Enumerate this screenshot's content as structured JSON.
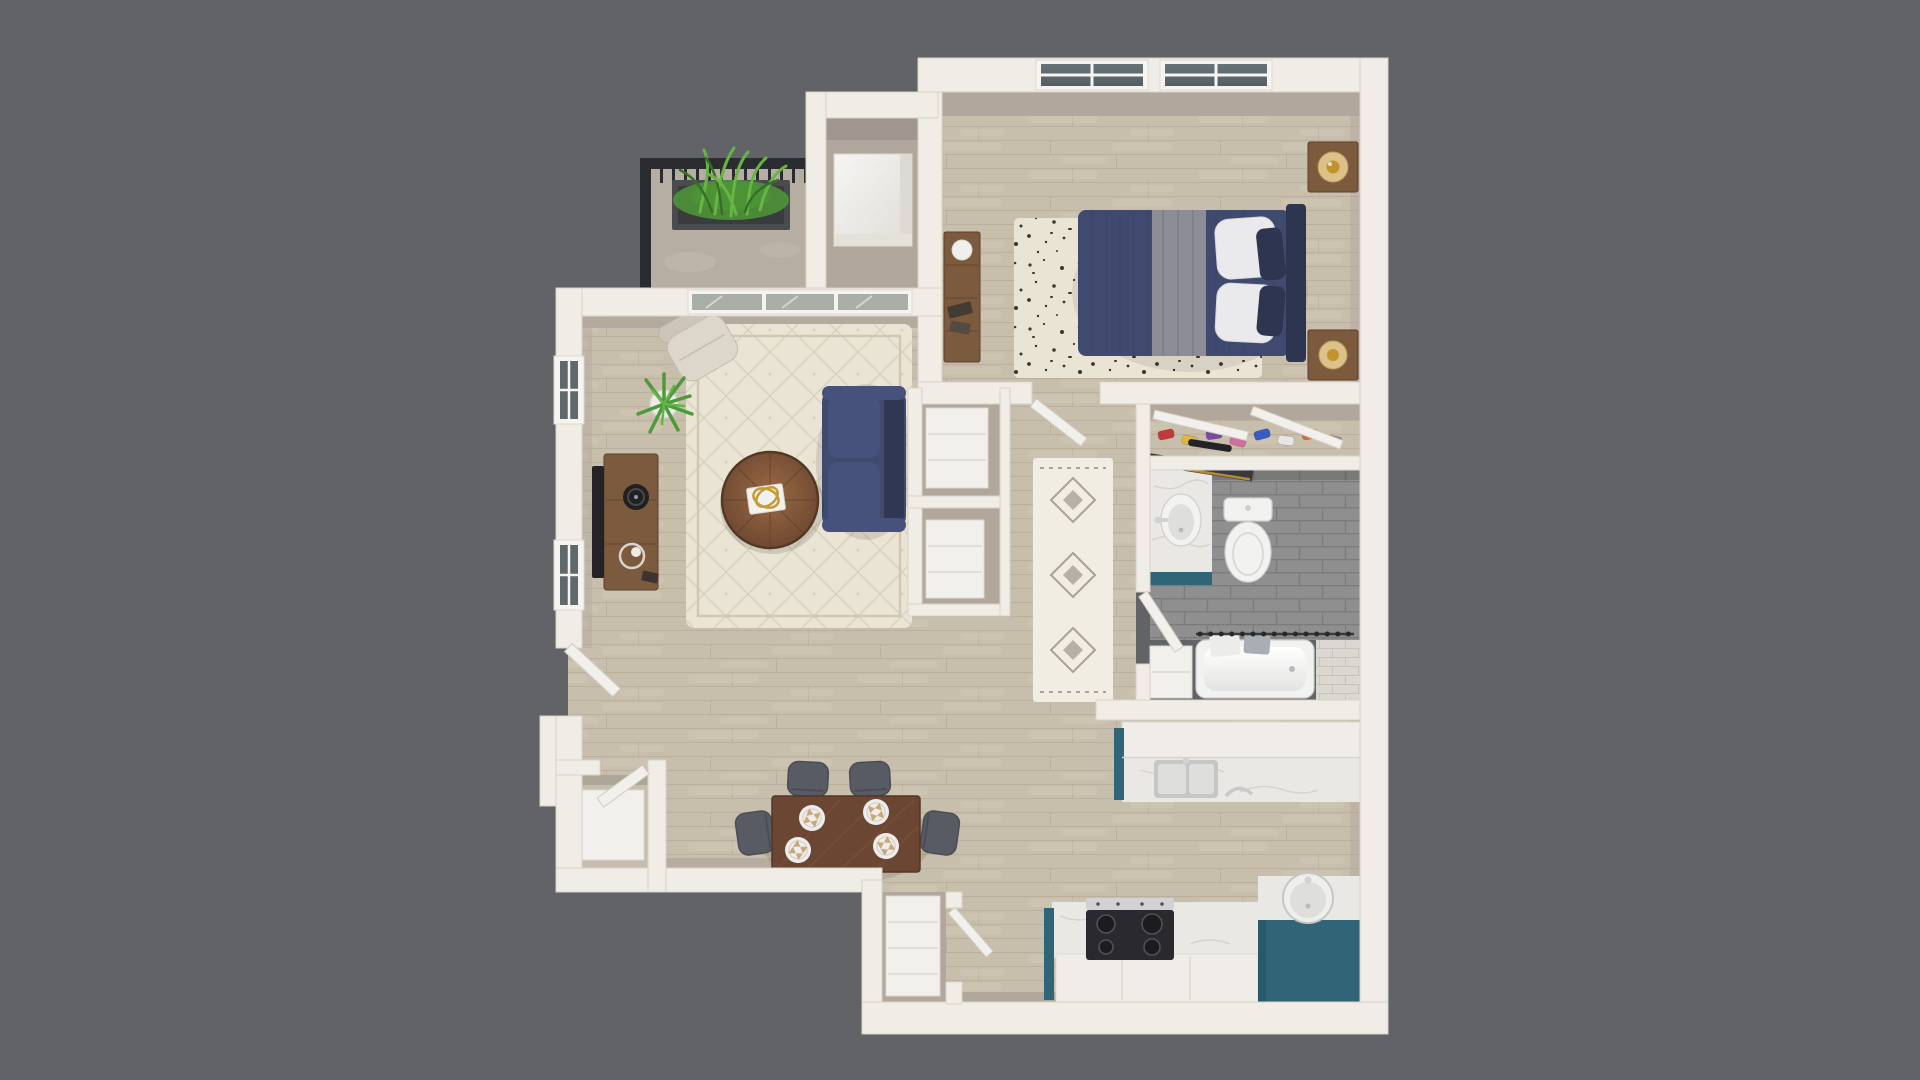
{
  "scene": {
    "type": "3d-floorplan-render",
    "description": "Top-down 3D dollhouse rendering of a one-bedroom, one-bathroom apartment floor plan centered on a plain dark gray background. No text, labels or UI controls are visible in the image.",
    "background": "#616367"
  },
  "palette": {
    "background": "#616367",
    "wall": "#f0ede7",
    "wallEdge": "#d8d2c8",
    "wallFace": "#b2a79d",
    "floorWood": "#c8beac",
    "floorLine": "#b4a995",
    "floorStreak": "#d6ccbb",
    "concrete": "#b6aea1",
    "railing": "#2b2c2f",
    "planter": "#494b4e",
    "soil": "#3a3b3d",
    "grass": "#4c9338",
    "grassLight": "#68b545",
    "grassDark": "#386f28",
    "rugCream": "#eae4d4",
    "rugBorder": "#d0c8b5",
    "rugSpeckle": "#3d362e",
    "runnerBase": "#f1ede2",
    "runnerGray": "#a8a195",
    "navy": "#3f4a6e",
    "navyDark": "#2e3550",
    "navyCushion": "#46527c",
    "grayThrow": "#8d8d97",
    "pillowWhite": "#eaeaec",
    "woodBrown": "#7b5a3e",
    "woodDark": "#5d3e2b",
    "tableWood": "#6b4733",
    "tableGrain": "#7d523a",
    "chairGray": "#585b63",
    "chairDark": "#4a4d55",
    "tvBlack": "#232327",
    "glassDark": "#5f686b",
    "glassPale": "#a9aea8",
    "doorWhite": "#f2f0ec",
    "teal": "#2f6577",
    "marble": "#eae8e4",
    "counterWhite": "#f0ede8",
    "vein": "#d7d3cc",
    "steel": "#d2d2d4",
    "stove": "#2a2a2e",
    "burner": "#1c1c1f",
    "burnerRing": "#505056",
    "tileGray": "#8f8f8f",
    "tileGrout": "#7c7c7c",
    "tileWhite": "#dbd8d2",
    "tileWhiteLine": "#c8c4bc",
    "porcelain": "#f2f2f1",
    "porcelainShade": "#dededd",
    "fixtureLine": "#cfcfcd",
    "lampGold": "#c1932f",
    "lampShade": "#dcc288",
    "gold": "#c59a33",
    "mirrorDark": "#39393b"
  },
  "rooms": [
    {
      "id": "balcony",
      "name": "Balcony",
      "items": [
        "black metal railing",
        "concrete floor",
        "dark planter box with tall green grass plant"
      ]
    },
    {
      "id": "utility-closet",
      "name": "Utility Closet",
      "items": [
        "white water heater"
      ]
    },
    {
      "id": "bedroom",
      "name": "Bedroom",
      "items": [
        "bed with navy duvet, gray throw blanket, white and navy pillows",
        "dark navy headboard",
        "two wood nightstands",
        "two brass lamps",
        "long wood dresser with decor",
        "cream speckled area rug",
        "two divided-lite windows with dark glass"
      ]
    },
    {
      "id": "bedroom-closet",
      "name": "Bedroom Closet",
      "items": [
        "angled sliding door panels",
        "row of colorful shoes"
      ]
    },
    {
      "id": "bathroom",
      "name": "Bathroom",
      "items": [
        "vanity with marble top, sink and teal cabinet",
        "leaning dark-framed mirror with gold trim",
        "black sconce bar",
        "toilet",
        "bathtub",
        "shower curtain rod with rings",
        "gray tile floor",
        "white tile tub surround",
        "linen nook"
      ]
    },
    {
      "id": "hallway",
      "name": "Hallway",
      "items": [
        "white runner rug with gray diamond motifs",
        "open bedroom door",
        "open bathroom door"
      ]
    },
    {
      "id": "linen-closets",
      "name": "Linen Closets",
      "items": [
        "white shelving unit",
        "white shelving unit"
      ]
    },
    {
      "id": "living-room",
      "name": "Living Room",
      "items": [
        "navy sofa",
        "round wood coffee table",
        "gold rings decor on white book",
        "dark wood TV console",
        "flat-screen TV",
        "record player",
        "round tray with candle",
        "cream accent chair",
        "potted snake plant",
        "cream patterned area rug",
        "sliding glass balcony door",
        "two windows with dark glass"
      ]
    },
    {
      "id": "dining-area",
      "name": "Dining Area",
      "items": [
        "rectangular dark wood dining table",
        "four gray upholstered chairs",
        "four white plates with tan napkins"
      ]
    },
    {
      "id": "kitchen",
      "name": "Kitchen",
      "items": [
        "breakfast-bar peninsula with double sink and faucet",
        "teal base cabinets",
        "white marble counters",
        "black four-burner cooktop with stainless trim",
        "corner counter with round sink"
      ]
    },
    {
      "id": "pantry",
      "name": "Pantry Closet",
      "items": [
        "white shelving",
        "open door"
      ]
    },
    {
      "id": "entry",
      "name": "Entry",
      "items": [
        "open front door",
        "coat closet with open door and white shelf"
      ]
    }
  ],
  "counts": {
    "dining_plates": 4,
    "dining_chairs": 4,
    "bedroom_windows": 2,
    "living_windows": 2,
    "closet_shoes": 8,
    "cooktop_burners": 4
  },
  "shoe_colors": [
    "#c23b3b",
    "#e0b93c",
    "#7a4a9e",
    "#cf6f9f",
    "#3a5ac4",
    "#e8e6e2",
    "#d86a2e",
    "#8a8d92"
  ]
}
